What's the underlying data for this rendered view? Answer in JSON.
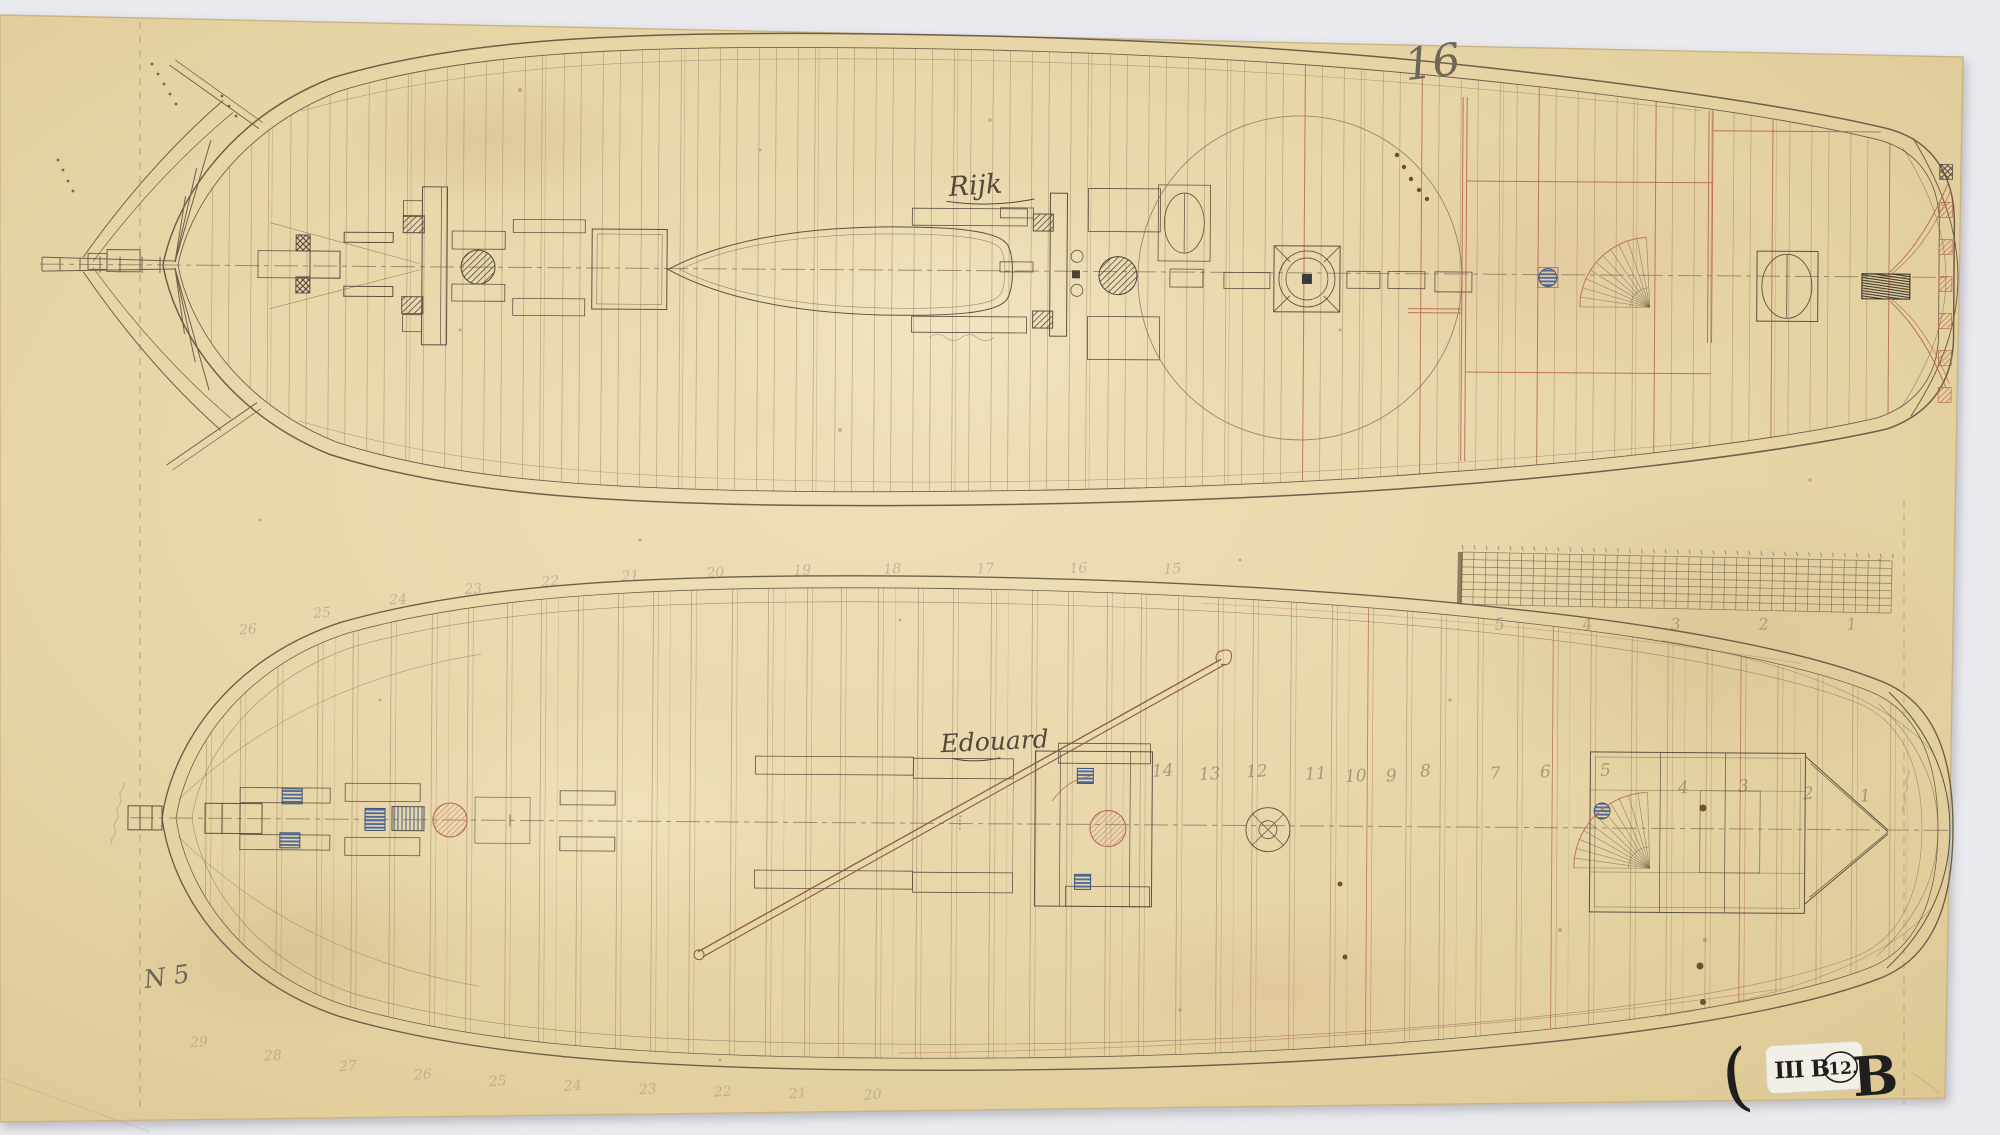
{
  "sheet": {
    "number": "16",
    "drawing_no": "N 5"
  },
  "ships": {
    "top": {
      "name": "Rijk"
    },
    "bottom": {
      "name": "Edouard",
      "stations_mid": [
        "14",
        "13",
        "12",
        "11",
        "10",
        "9",
        "8",
        "7",
        "6",
        "5",
        "4",
        "3",
        "2",
        "1"
      ],
      "stations_upper": [
        "26",
        "25",
        "24",
        "23",
        "22",
        "21",
        "20",
        "19",
        "18",
        "17",
        "16",
        "15"
      ],
      "stations_lower": [
        "29",
        "28",
        "27",
        "26",
        "25",
        "24",
        "23",
        "22",
        "21",
        "20"
      ]
    }
  },
  "scale_strip": {
    "numbers": [
      "5",
      "4",
      "3",
      "2",
      "1"
    ]
  },
  "archive_stamp": {
    "paren": "(",
    "series": "III B",
    "number": "12.",
    "suffix": "B"
  },
  "colors": {
    "background": "#e9e9ee",
    "paper": "#e7d5a7",
    "ink": "#6e5f4b",
    "ink_light": "#a08a68",
    "red": "#b4614a",
    "blue": "#4f6a9a",
    "pink": "#cc8877",
    "pencil": "#6f665a"
  }
}
